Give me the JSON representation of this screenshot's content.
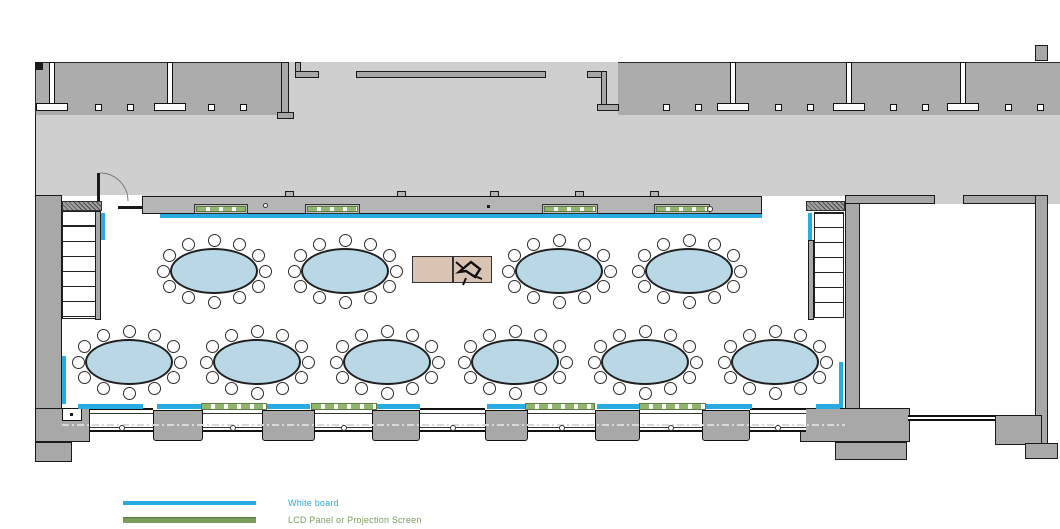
{
  "plan": {
    "type": "floor-plan",
    "room": "banquet / meeting room with corridor above and adjacent room at right"
  },
  "legend": {
    "items": [
      {
        "name": "white-board",
        "label": "White board",
        "color": "#29ABE2",
        "line_style": "solid"
      },
      {
        "name": "lcd-panel",
        "label": "LCD Panel or Projection Screen",
        "color": "#7D9B5B",
        "line_style": "bar"
      }
    ]
  },
  "palette": {
    "corridor": "#cfcfcf",
    "upper_rooms": "#acacac",
    "wall": "#a8a8a8",
    "wall_band": "#b5b5b5",
    "line": "#1a1a1a",
    "whiteboard": "#29ABE2",
    "lcd_panel": "#8FB56F",
    "table_fill": "#B9D7E4",
    "podium_fill": "#D9C4B4"
  },
  "furniture": {
    "tables": {
      "shape": "oval",
      "total": 10,
      "chairs_per_table": 12,
      "rx": 44,
      "ry": 23,
      "rows": [
        {
          "y": 271,
          "xs": [
            214,
            345,
            559,
            689
          ]
        },
        {
          "y": 362,
          "xs": [
            129,
            257,
            387,
            515,
            645,
            775
          ]
        }
      ]
    },
    "podium": {
      "x": 412,
      "y": 256,
      "w": 80,
      "h": 27,
      "sections": 2
    }
  },
  "features": {
    "stairs": 2,
    "doors": 1,
    "whiteboard_segments_top": 1,
    "lcd_segments_top": 4,
    "lcd_segments_bottom": 4
  }
}
